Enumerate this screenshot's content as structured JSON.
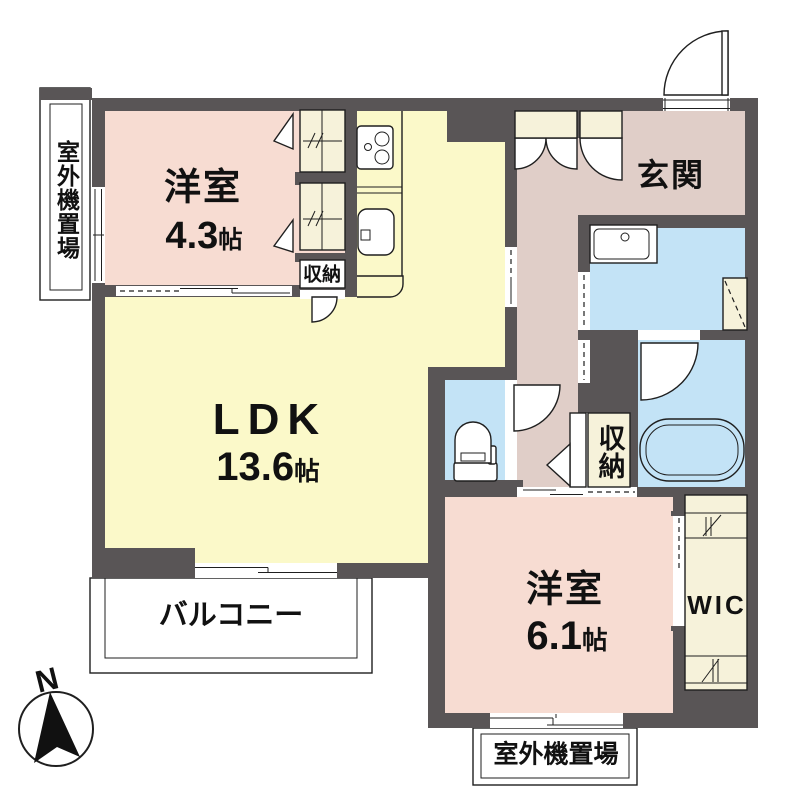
{
  "colors": {
    "wall": "#595556",
    "room_pink": "#f7dcd2",
    "ldk_yellow": "#fbf9c9",
    "hall_mauve": "#e0cec8",
    "water_blue": "#c3e3f6",
    "storage_cream": "#f6f2da",
    "line": "#1f1f1f",
    "text": "#111111"
  },
  "labels": {
    "bedroom1": {
      "name": "洋室",
      "size_value": "4.3",
      "size_unit": "帖"
    },
    "ldk": {
      "name": "LDK",
      "size_value": "13.6",
      "size_unit": "帖"
    },
    "entrance": {
      "name": "玄関"
    },
    "storage_top": {
      "name": "収納"
    },
    "storage_side": {
      "name": "収納"
    },
    "bedroom2": {
      "name": "洋室",
      "size_value": "6.1",
      "size_unit": "帖"
    },
    "wic": {
      "name": "WIC"
    },
    "balcony": {
      "name": "バルコニー"
    },
    "outdoor_unit_left": {
      "name": "室外機置場"
    },
    "outdoor_unit_bottom": {
      "name": "室外機置場"
    },
    "compass": {
      "north": "N"
    }
  }
}
